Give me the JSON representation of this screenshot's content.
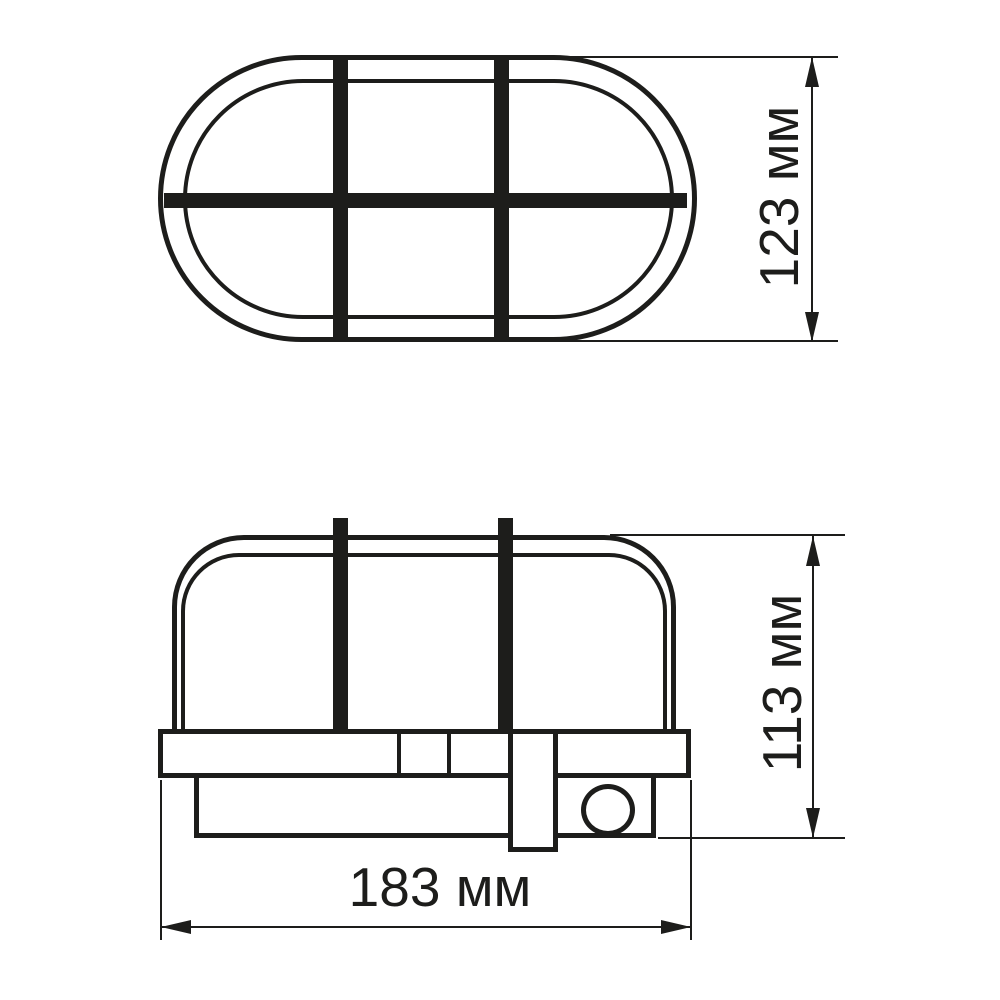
{
  "diagram": {
    "type": "technical-drawing",
    "subject": "oval bulkhead lamp with protective grille, two orthographic views",
    "background_color": "#ffffff",
    "line_color": "#1d1d1b",
    "dimensions": {
      "top_view_height": {
        "label": "123 мм",
        "value": 123,
        "unit": "мм"
      },
      "side_view_height": {
        "label": "113 мм",
        "value": 113,
        "unit": "мм"
      },
      "overall_width": {
        "label": "183 мм",
        "value": 183,
        "unit": "мм"
      }
    }
  }
}
